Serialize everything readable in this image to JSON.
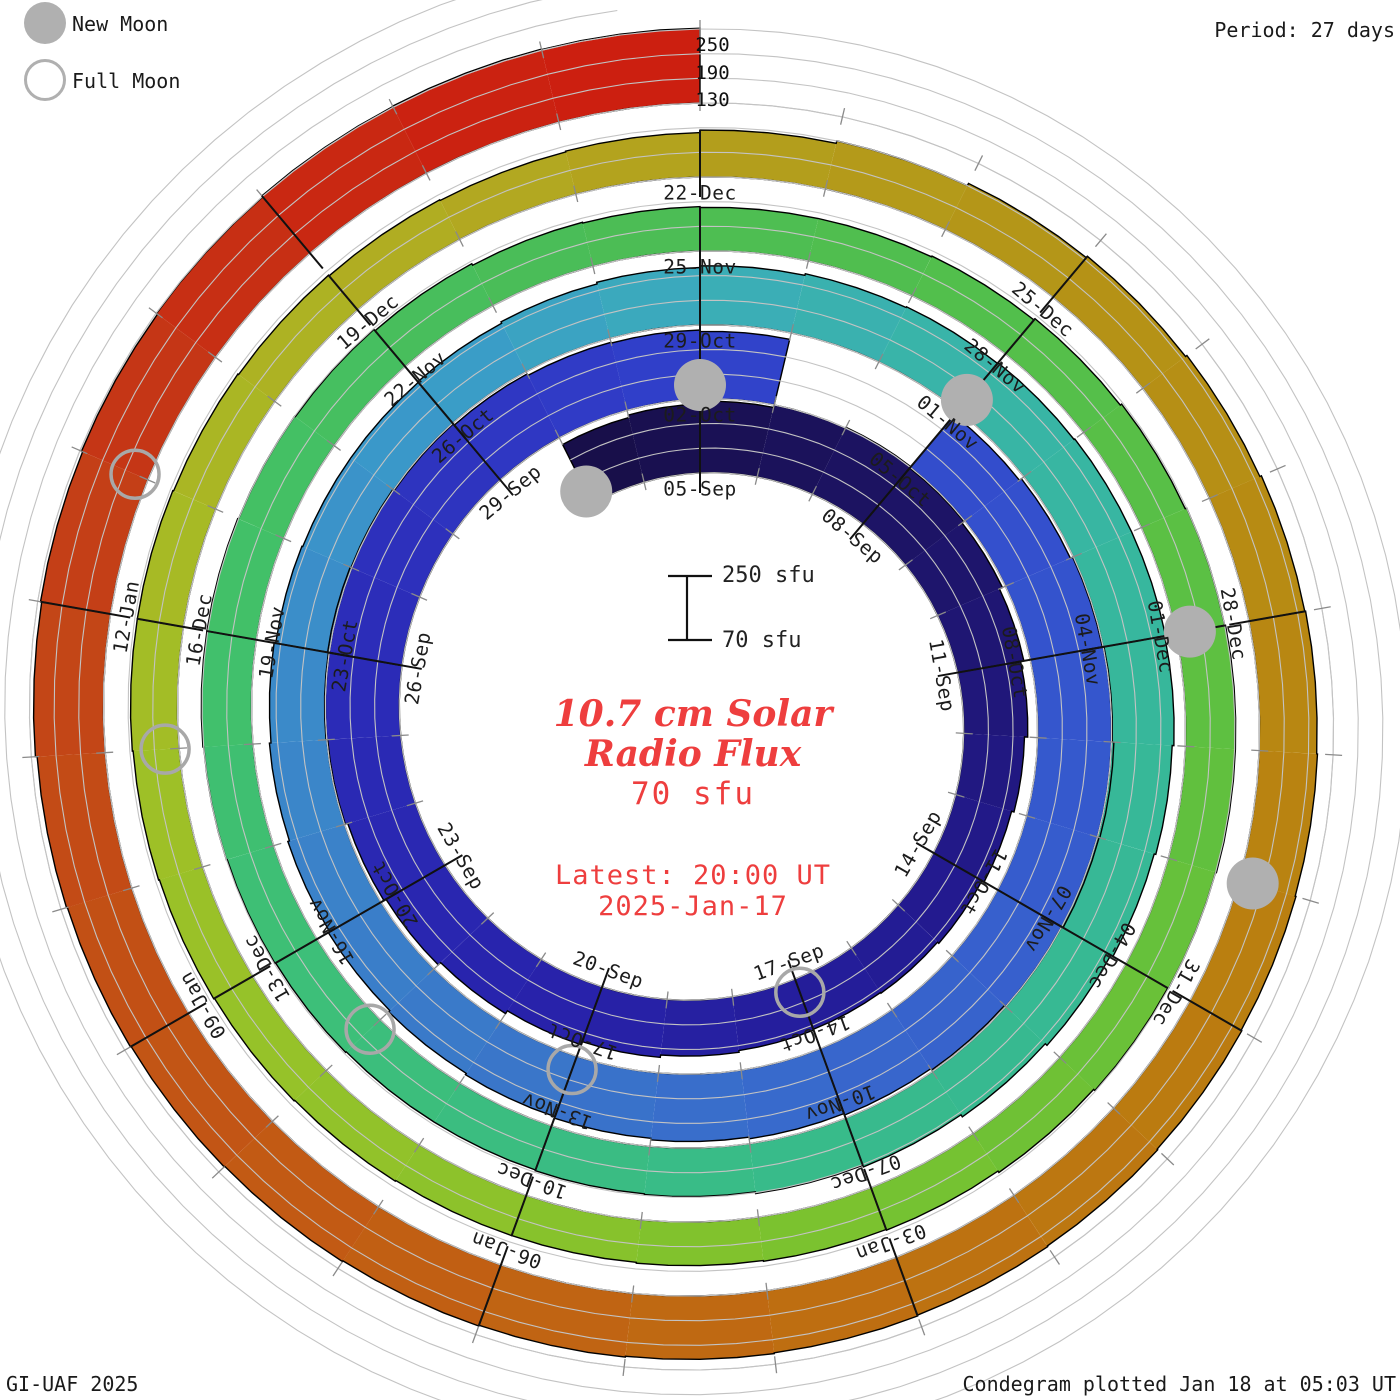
{
  "legend": {
    "new_moon": "New Moon",
    "full_moon": "Full Moon"
  },
  "header": {
    "period": "Period: 27 days"
  },
  "footer": {
    "left": "GI-UAF 2025",
    "right": "Condegram plotted Jan 18 at 05:03 UT"
  },
  "center": {
    "title_line1": "10.7 cm Solar",
    "title_line2": "Radio Flux",
    "current_value": "70 sfu",
    "latest_line1": "Latest: 20:00 UT",
    "latest_line2": "2025-Jan-17"
  },
  "scale_indicator": {
    "top_label": "250 sfu",
    "bottom_label": "70 sfu"
  },
  "radial_axis": {
    "0": "250",
    "1": "190",
    "2": "130"
  },
  "colors": {
    "background": "#ffffff",
    "label_text": "#1c1c1c",
    "grid": "#c3c3c3",
    "tick": "#8a8a8a",
    "outline": "#000000",
    "moon_fill": "#b0b0b0",
    "moon_stroke": "#a8a8a8",
    "accent_red": "#ee3e3e"
  },
  "chart_data": {
    "type": "bar",
    "subtype": "condegram_spiral",
    "title": "10.7 cm Solar Radio Flux",
    "period_days": 27,
    "label_step_days": 3,
    "start_date": "2024-09-03",
    "latest_date": "2025-01-17",
    "latest_time": "20:00 UT",
    "baseline_sfu": 70,
    "gridlines_sfu": [
      70,
      130,
      190,
      250
    ],
    "date_labels": [
      "05-Sep",
      "08-Sep",
      "11-Sep",
      "14-Sep",
      "17-Sep",
      "20-Sep",
      "23-Sep",
      "26-Sep",
      "29-Sep",
      "02-Oct",
      "05-Oct",
      "08-Oct",
      "11-Oct",
      "14-Oct",
      "17-Oct",
      "20-Oct",
      "23-Oct",
      "26-Oct",
      "29-Oct",
      "01-Nov",
      "04-Nov",
      "07-Nov",
      "10-Nov",
      "13-Nov",
      "16-Nov",
      "19-Nov",
      "22-Nov",
      "25-Nov",
      "28-Nov",
      "01-Dec",
      "04-Dec",
      "07-Dec",
      "10-Dec",
      "13-Dec",
      "16-Dec",
      "19-Dec",
      "22-Dec",
      "25-Dec",
      "28-Dec",
      "31-Dec",
      "03-Jan",
      "06-Jan",
      "09-Jan",
      "12-Jan"
    ],
    "daily_flux_sfu": [
      232,
      238,
      244,
      250,
      252,
      248,
      242,
      234,
      226,
      218,
      212,
      206,
      202,
      200,
      202,
      206,
      212,
      220,
      228,
      236,
      242,
      248,
      252,
      254,
      252,
      248,
      244,
      240,
      238,
      234,
      null,
      null,
      236,
      242,
      248,
      252,
      256,
      254,
      250,
      246,
      242,
      238,
      234,
      230,
      226,
      222,
      218,
      214,
      210,
      206,
      202,
      200,
      200,
      202,
      206,
      210,
      214,
      218,
      220,
      222,
      224,
      224,
      222,
      218,
      214,
      208,
      202,
      196,
      192,
      188,
      186,
      184,
      184,
      186,
      188,
      190,
      192,
      192,
      190,
      188,
      184,
      180,
      178,
      176,
      176,
      178,
      182,
      186,
      190,
      192,
      192,
      190,
      188,
      184,
      180,
      178,
      176,
      174,
      174,
      176,
      178,
      180,
      182,
      184,
      184,
      182,
      180,
      178,
      176,
      178,
      184,
      190,
      196,
      200,
      204,
      208,
      210,
      212,
      214,
      216,
      218,
      220,
      222,
      224,
      226,
      228,
      230,
      232,
      234,
      236,
      240,
      243,
      246,
      249,
      252,
      253,
      252
    ],
    "color_stops": [
      [
        0,
        "#170e47"
      ],
      [
        6,
        "#1d1469"
      ],
      [
        12,
        "#231b92"
      ],
      [
        18,
        "#2823ac"
      ],
      [
        24,
        "#2c2eba"
      ],
      [
        28,
        "#303dc8"
      ],
      [
        31,
        "#3248cc"
      ],
      [
        36,
        "#3557cd"
      ],
      [
        41,
        "#3868cc"
      ],
      [
        45,
        "#3a78c9"
      ],
      [
        50,
        "#3b8cc9"
      ],
      [
        53,
        "#3a9ac9"
      ],
      [
        56,
        "#3bacba"
      ],
      [
        58,
        "#39b3ab"
      ],
      [
        62,
        "#37b79c"
      ],
      [
        66,
        "#37b992"
      ],
      [
        70,
        "#39bc85"
      ],
      [
        74,
        "#3dbf77"
      ],
      [
        78,
        "#43c066"
      ],
      [
        82,
        "#4bbd56"
      ],
      [
        86,
        "#53bf4b"
      ],
      [
        90,
        "#5fc040"
      ],
      [
        93,
        "#6cc136"
      ],
      [
        96,
        "#7ec22e"
      ],
      [
        99,
        "#90c22a"
      ],
      [
        102,
        "#9cc127"
      ],
      [
        105,
        "#a9b824"
      ],
      [
        108,
        "#b1ab22"
      ],
      [
        110,
        "#b3a01d"
      ],
      [
        113,
        "#b49417"
      ],
      [
        116,
        "#b78912"
      ],
      [
        119,
        "#ba7d10"
      ],
      [
        122,
        "#bd7011"
      ],
      [
        125,
        "#c16113"
      ],
      [
        128,
        "#c25215"
      ],
      [
        131,
        "#c34317"
      ],
      [
        133,
        "#c63215"
      ],
      [
        135,
        "#ca2411"
      ],
      [
        136,
        "#cc1f10"
      ]
    ],
    "moons": {
      "new_moon_day_indices": [
        0,
        29,
        59,
        89,
        118
      ],
      "new_moon_dates": [
        "03-Sep",
        "02-Oct",
        "01-Nov",
        "01-Dec",
        "30-Dec"
      ],
      "full_moon_day_indices": [
        14,
        44,
        73,
        103,
        132
      ],
      "full_moon_dates": [
        "17-Sep",
        "17-Oct",
        "15-Nov",
        "15-Dec",
        "13-Jan"
      ]
    },
    "layout": {
      "center_x": 700,
      "center_y": 718,
      "base_radius_px": 245,
      "radius_per_revolution_px": 74,
      "px_per_sfu": 0.411,
      "direction": "clockwise",
      "start_angle": "top"
    }
  }
}
